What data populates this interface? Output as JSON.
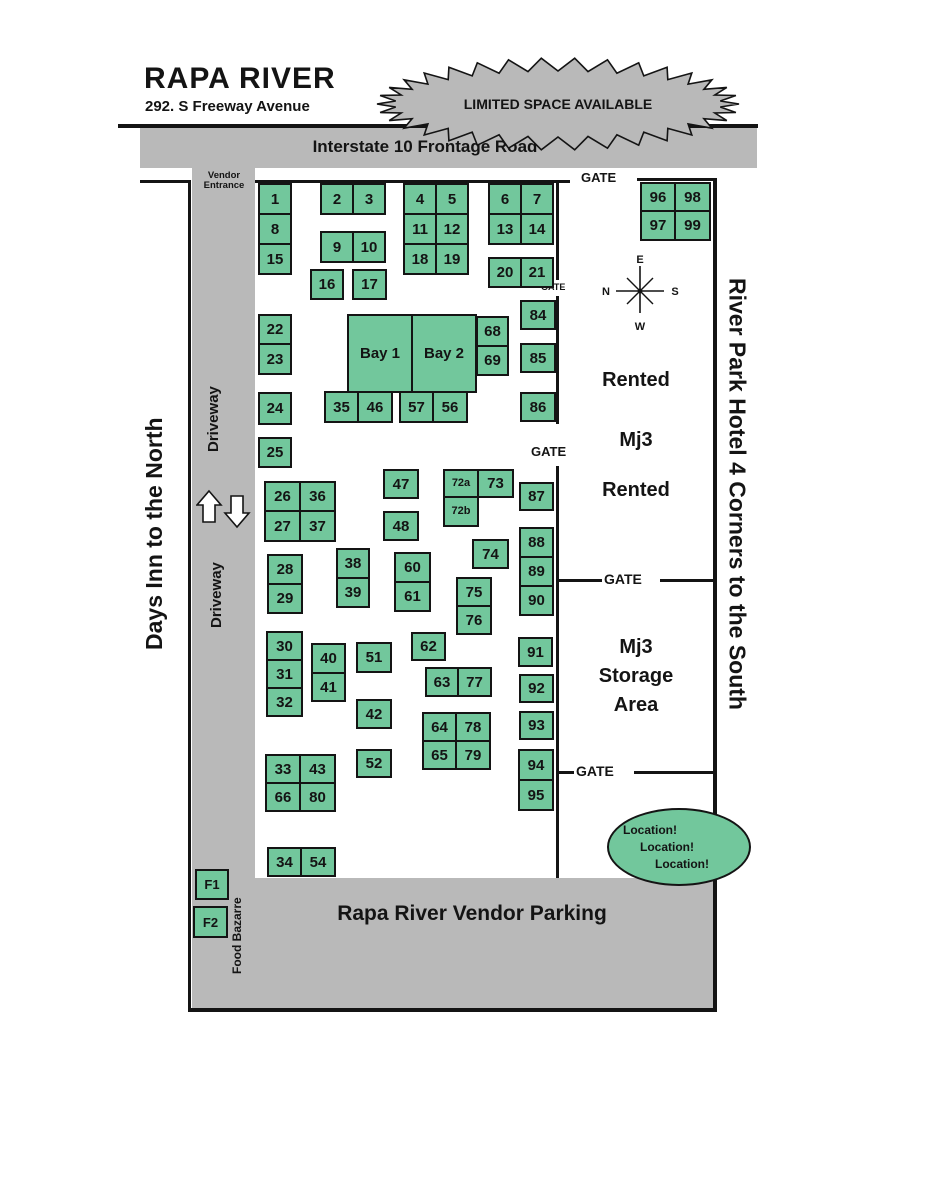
{
  "header": {
    "title": "RAPA RIVER",
    "address": "292. S Freeway Avenue"
  },
  "banner": {
    "text": "LIMITED SPACE AVAILABLE"
  },
  "road": {
    "label": "Interstate 10 Frontage Road"
  },
  "left_side": {
    "days_inn": "Days Inn to the North",
    "driveway_upper": "Driveway",
    "driveway_lower": "Driveway",
    "vendor_entrance": "Vendor Entrance",
    "food_bazarre": "Food Bazarre"
  },
  "right_side": {
    "hotel": "River Park Hotel 4 Corners to the South",
    "rented_top": "Rented",
    "mj3": "Mj3",
    "rented_bottom": "Rented",
    "storage_line1": "Mj3",
    "storage_line2": "Storage",
    "storage_line3": "Area"
  },
  "gates": {
    "top": "GATE",
    "small": "GATE",
    "mid": "GATE",
    "storage_gate": "GATE",
    "south_gate": "GATE"
  },
  "compass": {
    "e": "E",
    "n": "N",
    "s": "S",
    "w": "W"
  },
  "parking": {
    "label": "Rapa River Vendor Parking"
  },
  "location_badge": {
    "line1": "Location!",
    "line2": "Location!",
    "line3": "Location!"
  },
  "colors": {
    "booth_green": "#72c79c",
    "gray": "#b9b9b9",
    "ink": "#141414"
  },
  "bays": [
    {
      "label": "Bay 1",
      "x": 347,
      "y": 314,
      "w": 66,
      "h": 79
    },
    {
      "label": "Bay 2",
      "x": 411,
      "y": 314,
      "w": 66,
      "h": 79
    }
  ],
  "booths": [
    {
      "label": "1",
      "x": 258,
      "y": 183,
      "w": 34,
      "h": 32
    },
    {
      "label": "8",
      "x": 258,
      "y": 213,
      "w": 34,
      "h": 32
    },
    {
      "label": "15",
      "x": 258,
      "y": 243,
      "w": 34,
      "h": 32
    },
    {
      "label": "2",
      "x": 320,
      "y": 183,
      "w": 34,
      "h": 32
    },
    {
      "label": "3",
      "x": 352,
      "y": 183,
      "w": 34,
      "h": 32
    },
    {
      "label": "9",
      "x": 320,
      "y": 231,
      "w": 34,
      "h": 32
    },
    {
      "label": "10",
      "x": 352,
      "y": 231,
      "w": 34,
      "h": 32
    },
    {
      "label": "16",
      "x": 310,
      "y": 269,
      "w": 34,
      "h": 31
    },
    {
      "label": "17",
      "x": 352,
      "y": 269,
      "w": 35,
      "h": 31
    },
    {
      "label": "4",
      "x": 403,
      "y": 183,
      "w": 34,
      "h": 32
    },
    {
      "label": "5",
      "x": 435,
      "y": 183,
      "w": 34,
      "h": 32
    },
    {
      "label": "11",
      "x": 403,
      "y": 213,
      "w": 34,
      "h": 32
    },
    {
      "label": "12",
      "x": 435,
      "y": 213,
      "w": 34,
      "h": 32
    },
    {
      "label": "18",
      "x": 403,
      "y": 243,
      "w": 34,
      "h": 32
    },
    {
      "label": "19",
      "x": 435,
      "y": 243,
      "w": 34,
      "h": 32
    },
    {
      "label": "6",
      "x": 488,
      "y": 183,
      "w": 34,
      "h": 32
    },
    {
      "label": "7",
      "x": 520,
      "y": 183,
      "w": 34,
      "h": 32
    },
    {
      "label": "13",
      "x": 488,
      "y": 213,
      "w": 34,
      "h": 32
    },
    {
      "label": "14",
      "x": 520,
      "y": 213,
      "w": 34,
      "h": 32
    },
    {
      "label": "20",
      "x": 488,
      "y": 257,
      "w": 34,
      "h": 31
    },
    {
      "label": "21",
      "x": 520,
      "y": 257,
      "w": 34,
      "h": 31
    },
    {
      "label": "96",
      "x": 640,
      "y": 182,
      "w": 36,
      "h": 30
    },
    {
      "label": "98",
      "x": 674,
      "y": 182,
      "w": 37,
      "h": 30
    },
    {
      "label": "97",
      "x": 640,
      "y": 210,
      "w": 36,
      "h": 31
    },
    {
      "label": "99",
      "x": 674,
      "y": 210,
      "w": 37,
      "h": 31
    },
    {
      "label": "22",
      "x": 258,
      "y": 314,
      "w": 34,
      "h": 31
    },
    {
      "label": "23",
      "x": 258,
      "y": 343,
      "w": 34,
      "h": 32
    },
    {
      "label": "24",
      "x": 258,
      "y": 392,
      "w": 34,
      "h": 33
    },
    {
      "label": "25",
      "x": 258,
      "y": 437,
      "w": 34,
      "h": 31
    },
    {
      "label": "68",
      "x": 476,
      "y": 316,
      "w": 33,
      "h": 31
    },
    {
      "label": "69",
      "x": 476,
      "y": 345,
      "w": 33,
      "h": 31
    },
    {
      "label": "35",
      "x": 324,
      "y": 391,
      "w": 35,
      "h": 32
    },
    {
      "label": "46",
      "x": 357,
      "y": 391,
      "w": 36,
      "h": 32
    },
    {
      "label": "57",
      "x": 399,
      "y": 391,
      "w": 35,
      "h": 32
    },
    {
      "label": "56",
      "x": 432,
      "y": 391,
      "w": 36,
      "h": 32
    },
    {
      "label": "84",
      "x": 520,
      "y": 300,
      "w": 36,
      "h": 30
    },
    {
      "label": "85",
      "x": 520,
      "y": 343,
      "w": 36,
      "h": 30
    },
    {
      "label": "86",
      "x": 520,
      "y": 392,
      "w": 36,
      "h": 30
    },
    {
      "label": "26",
      "x": 264,
      "y": 481,
      "w": 37,
      "h": 31
    },
    {
      "label": "36",
      "x": 299,
      "y": 481,
      "w": 37,
      "h": 31
    },
    {
      "label": "27",
      "x": 264,
      "y": 510,
      "w": 37,
      "h": 32
    },
    {
      "label": "37",
      "x": 299,
      "y": 510,
      "w": 37,
      "h": 32
    },
    {
      "label": "47",
      "x": 383,
      "y": 469,
      "w": 36,
      "h": 30
    },
    {
      "label": "48",
      "x": 383,
      "y": 511,
      "w": 36,
      "h": 30
    },
    {
      "label": "72a",
      "x": 443,
      "y": 469,
      "w": 36,
      "h": 29,
      "fs": 11
    },
    {
      "label": "73",
      "x": 477,
      "y": 469,
      "w": 37,
      "h": 29
    },
    {
      "label": "72b",
      "x": 443,
      "y": 496,
      "w": 36,
      "h": 31,
      "fs": 11
    },
    {
      "label": "87",
      "x": 519,
      "y": 482,
      "w": 35,
      "h": 29
    },
    {
      "label": "74",
      "x": 472,
      "y": 539,
      "w": 37,
      "h": 30
    },
    {
      "label": "88",
      "x": 519,
      "y": 527,
      "w": 35,
      "h": 31
    },
    {
      "label": "89",
      "x": 519,
      "y": 556,
      "w": 35,
      "h": 31
    },
    {
      "label": "90",
      "x": 519,
      "y": 585,
      "w": 35,
      "h": 31
    },
    {
      "label": "28",
      "x": 267,
      "y": 554,
      "w": 36,
      "h": 31
    },
    {
      "label": "29",
      "x": 267,
      "y": 583,
      "w": 36,
      "h": 31
    },
    {
      "label": "38",
      "x": 336,
      "y": 548,
      "w": 34,
      "h": 31
    },
    {
      "label": "39",
      "x": 336,
      "y": 577,
      "w": 34,
      "h": 31
    },
    {
      "label": "60",
      "x": 394,
      "y": 552,
      "w": 37,
      "h": 31
    },
    {
      "label": "61",
      "x": 394,
      "y": 581,
      "w": 37,
      "h": 31
    },
    {
      "label": "75",
      "x": 456,
      "y": 577,
      "w": 36,
      "h": 30
    },
    {
      "label": "76",
      "x": 456,
      "y": 605,
      "w": 36,
      "h": 30
    },
    {
      "label": "30",
      "x": 266,
      "y": 631,
      "w": 37,
      "h": 30
    },
    {
      "label": "31",
      "x": 266,
      "y": 659,
      "w": 37,
      "h": 30
    },
    {
      "label": "32",
      "x": 266,
      "y": 687,
      "w": 37,
      "h": 30
    },
    {
      "label": "40",
      "x": 311,
      "y": 643,
      "w": 35,
      "h": 31
    },
    {
      "label": "41",
      "x": 311,
      "y": 672,
      "w": 35,
      "h": 30
    },
    {
      "label": "51",
      "x": 356,
      "y": 642,
      "w": 36,
      "h": 31
    },
    {
      "label": "62",
      "x": 411,
      "y": 632,
      "w": 35,
      "h": 29
    },
    {
      "label": "63",
      "x": 425,
      "y": 667,
      "w": 34,
      "h": 30
    },
    {
      "label": "77",
      "x": 457,
      "y": 667,
      "w": 35,
      "h": 30
    },
    {
      "label": "42",
      "x": 356,
      "y": 699,
      "w": 36,
      "h": 30
    },
    {
      "label": "64",
      "x": 422,
      "y": 712,
      "w": 35,
      "h": 30
    },
    {
      "label": "78",
      "x": 455,
      "y": 712,
      "w": 36,
      "h": 30
    },
    {
      "label": "65",
      "x": 422,
      "y": 740,
      "w": 35,
      "h": 30
    },
    {
      "label": "79",
      "x": 455,
      "y": 740,
      "w": 36,
      "h": 30
    },
    {
      "label": "52",
      "x": 356,
      "y": 749,
      "w": 36,
      "h": 29
    },
    {
      "label": "33",
      "x": 265,
      "y": 754,
      "w": 36,
      "h": 30
    },
    {
      "label": "43",
      "x": 299,
      "y": 754,
      "w": 37,
      "h": 30
    },
    {
      "label": "66",
      "x": 265,
      "y": 782,
      "w": 36,
      "h": 30
    },
    {
      "label": "80",
      "x": 299,
      "y": 782,
      "w": 37,
      "h": 30
    },
    {
      "label": "91",
      "x": 518,
      "y": 637,
      "w": 35,
      "h": 30
    },
    {
      "label": "92",
      "x": 519,
      "y": 674,
      "w": 35,
      "h": 29
    },
    {
      "label": "93",
      "x": 519,
      "y": 711,
      "w": 35,
      "h": 29
    },
    {
      "label": "94",
      "x": 518,
      "y": 749,
      "w": 36,
      "h": 32
    },
    {
      "label": "95",
      "x": 518,
      "y": 779,
      "w": 36,
      "h": 32
    },
    {
      "label": "34",
      "x": 267,
      "y": 847,
      "w": 35,
      "h": 30
    },
    {
      "label": "54",
      "x": 300,
      "y": 847,
      "w": 36,
      "h": 30
    },
    {
      "label": "F1",
      "x": 195,
      "y": 869,
      "w": 34,
      "h": 31,
      "fs": 13
    },
    {
      "label": "F2",
      "x": 193,
      "y": 906,
      "w": 35,
      "h": 32,
      "fs": 13
    }
  ]
}
